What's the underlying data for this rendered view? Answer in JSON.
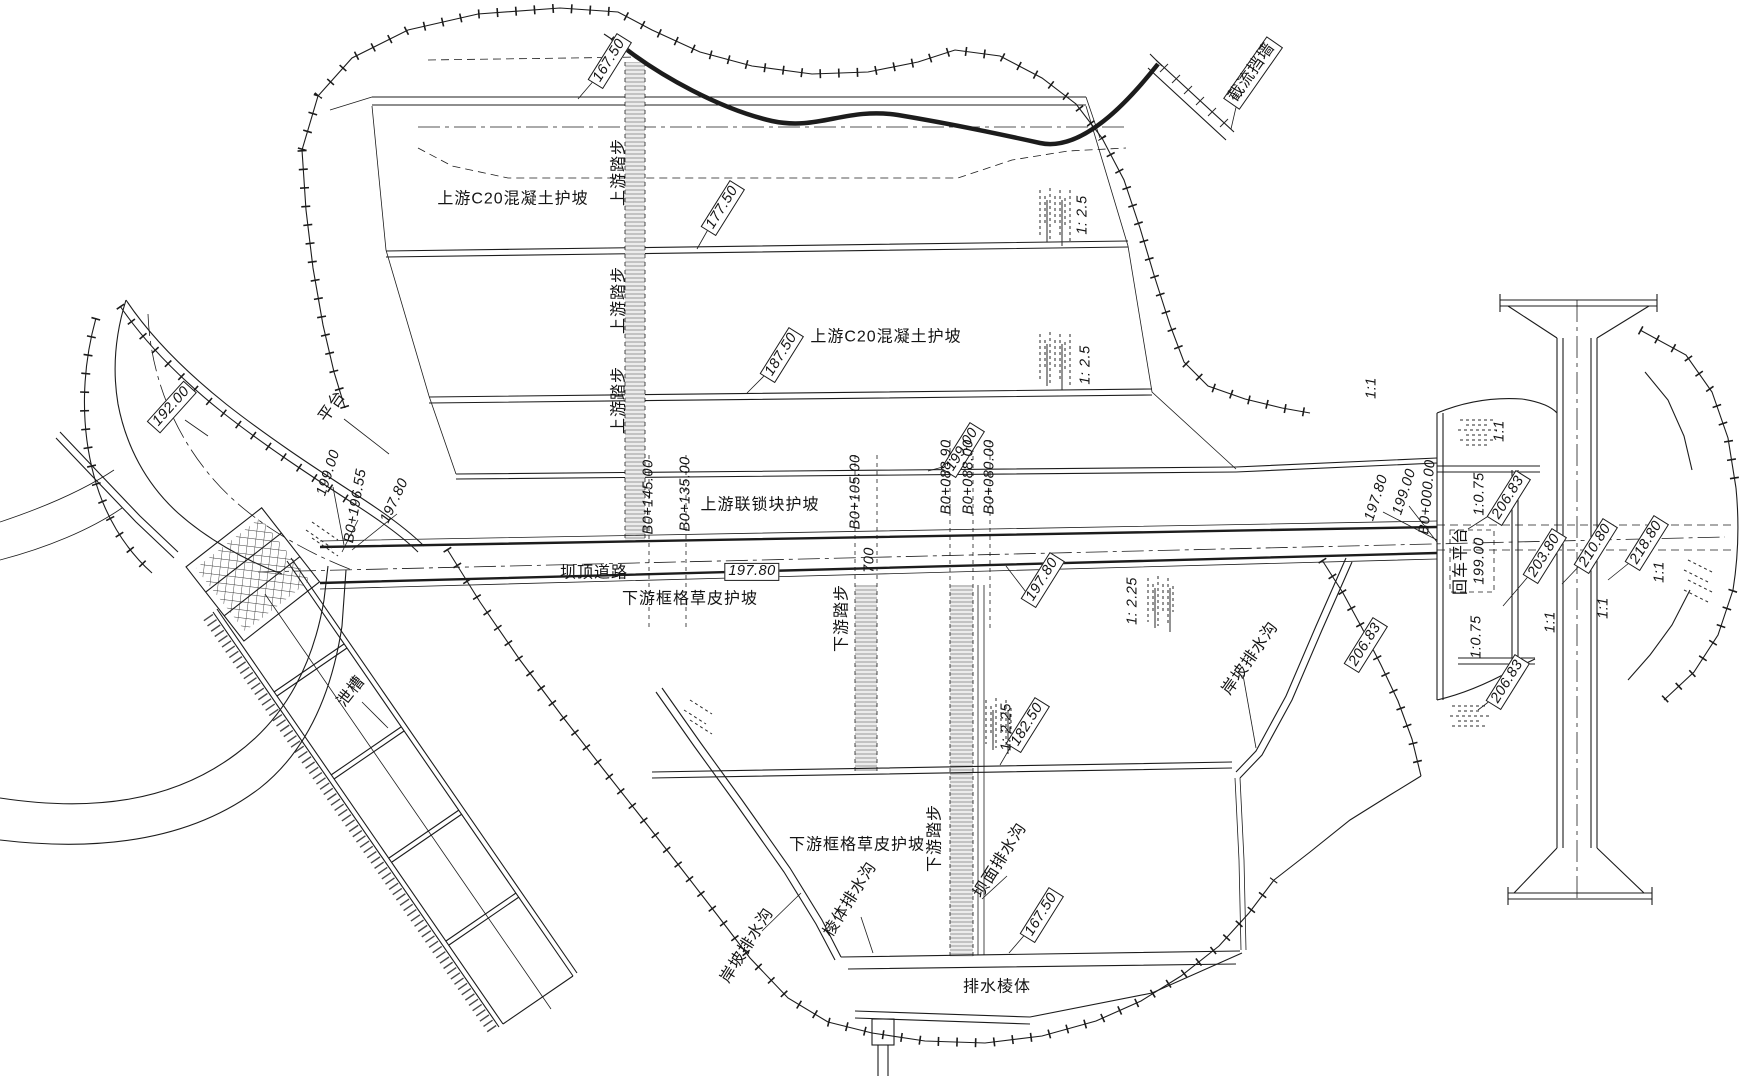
{
  "drawing": {
    "kind": "dam-plan-view",
    "language": "zh-CN",
    "colors": {
      "line": "#1c1c1c",
      "background": "#ffffff",
      "stair_hatch": "#e8e8e8"
    }
  },
  "labels": [
    {
      "name": "elev-167-50-upstream",
      "text": "167.50",
      "x": 610,
      "y": 61,
      "rot": -58,
      "box": true,
      "kind": "num"
    },
    {
      "name": "upstream-steps-1",
      "text": "上游踏步",
      "x": 620,
      "y": 172,
      "rot": -90,
      "box": false,
      "kind": "cn"
    },
    {
      "name": "upstream-c20-slope-1",
      "text": "上游C20混凝土护坡",
      "x": 513,
      "y": 200,
      "rot": 0,
      "box": false,
      "kind": "cn"
    },
    {
      "name": "elev-177-50",
      "text": "177.50",
      "x": 723,
      "y": 208,
      "rot": -58,
      "box": true,
      "kind": "num"
    },
    {
      "name": "slope-1-2-5-a",
      "text": "1: 2.5",
      "x": 1083,
      "y": 215,
      "rot": -90,
      "box": false,
      "kind": "num"
    },
    {
      "name": "upstream-steps-2",
      "text": "上游踏步",
      "x": 620,
      "y": 300,
      "rot": -90,
      "box": false,
      "kind": "cn"
    },
    {
      "name": "upstream-c20-slope-2",
      "text": "上游C20混凝土护坡",
      "x": 886,
      "y": 338,
      "rot": 0,
      "box": false,
      "kind": "cn"
    },
    {
      "name": "elev-187-50",
      "text": "187.50",
      "x": 782,
      "y": 355,
      "rot": -58,
      "box": true,
      "kind": "num"
    },
    {
      "name": "slope-1-2-5-b",
      "text": "1: 2.5",
      "x": 1086,
      "y": 365,
      "rot": -90,
      "box": false,
      "kind": "num"
    },
    {
      "name": "upstream-steps-3",
      "text": "上游踏步",
      "x": 620,
      "y": 400,
      "rot": -90,
      "box": false,
      "kind": "cn"
    },
    {
      "name": "closure-wall-label",
      "text": "截流挡墙",
      "x": 1253,
      "y": 73,
      "rot": -55,
      "box": true,
      "kind": "cn"
    },
    {
      "name": "elev-199-00-upstream",
      "text": "199.00",
      "x": 963,
      "y": 450,
      "rot": -58,
      "box": true,
      "kind": "num"
    },
    {
      "name": "upstream-interlock-slope",
      "text": "上游联锁块护坡",
      "x": 760,
      "y": 506,
      "rot": 0,
      "box": false,
      "kind": "cn"
    },
    {
      "name": "crest-road-label",
      "text": "坝顶道路",
      "x": 594,
      "y": 574,
      "rot": 0,
      "box": false,
      "kind": "cn"
    },
    {
      "name": "elev-197-80-road",
      "text": "197.80",
      "x": 752,
      "y": 572,
      "rot": 0,
      "box": true,
      "kind": "num"
    },
    {
      "name": "station-b0-145",
      "text": "B0+145.00",
      "x": 649,
      "y": 497,
      "rot": -90,
      "box": false,
      "kind": "num"
    },
    {
      "name": "station-b0-135",
      "text": "B0+135.00",
      "x": 686,
      "y": 494,
      "rot": -90,
      "box": false,
      "kind": "num"
    },
    {
      "name": "station-b0-105",
      "text": "B0+105.00",
      "x": 856,
      "y": 492,
      "rot": -90,
      "box": false,
      "kind": "num"
    },
    {
      "name": "dim-700",
      "text": "700",
      "x": 870,
      "y": 560,
      "rot": -90,
      "box": false,
      "kind": "num"
    },
    {
      "name": "station-b0-088-90",
      "text": "B0+088.90",
      "x": 947,
      "y": 477,
      "rot": -90,
      "box": false,
      "kind": "num"
    },
    {
      "name": "station-b0-088-00",
      "text": "B0+088.00",
      "x": 969,
      "y": 477,
      "rot": -90,
      "box": false,
      "kind": "num"
    },
    {
      "name": "station-b0-080-00",
      "text": "B0+080.00",
      "x": 990,
      "y": 477,
      "rot": -90,
      "box": false,
      "kind": "num"
    },
    {
      "name": "elev-192-00",
      "text": "192.00",
      "x": 172,
      "y": 407,
      "rot": -48,
      "box": true,
      "kind": "num"
    },
    {
      "name": "platform-label",
      "text": "平台",
      "x": 333,
      "y": 407,
      "rot": -55,
      "box": false,
      "kind": "cn"
    },
    {
      "name": "elev-199-00-left",
      "text": "199.00",
      "x": 329,
      "y": 473,
      "rot": -72,
      "box": false,
      "kind": "num"
    },
    {
      "name": "station-b0-196-55",
      "text": "B0+196.55",
      "x": 356,
      "y": 506,
      "rot": -80,
      "box": false,
      "kind": "num"
    },
    {
      "name": "elev-197-80-left",
      "text": "197.80",
      "x": 395,
      "y": 501,
      "rot": -65,
      "box": false,
      "kind": "num"
    },
    {
      "name": "chute-label",
      "text": "泄槽",
      "x": 352,
      "y": 692,
      "rot": -52,
      "box": false,
      "kind": "cn"
    },
    {
      "name": "downstream-grass-slope-1",
      "text": "下游框格草皮护坡",
      "x": 690,
      "y": 600,
      "rot": 0,
      "box": false,
      "kind": "cn"
    },
    {
      "name": "elev-197-80-downstream",
      "text": "197.80",
      "x": 1043,
      "y": 580,
      "rot": -58,
      "box": true,
      "kind": "num"
    },
    {
      "name": "slope-1-2-25-a",
      "text": "1: 2.25",
      "x": 1133,
      "y": 601,
      "rot": -90,
      "box": false,
      "kind": "num"
    },
    {
      "name": "downstream-steps-1",
      "text": "下游踏步",
      "x": 843,
      "y": 618,
      "rot": -90,
      "box": false,
      "kind": "cn"
    },
    {
      "name": "elev-182-50",
      "text": "182.50",
      "x": 1028,
      "y": 725,
      "rot": -58,
      "box": true,
      "kind": "num"
    },
    {
      "name": "bank-drain-right",
      "text": "岸坡排水沟",
      "x": 1251,
      "y": 659,
      "rot": -55,
      "box": false,
      "kind": "cn"
    },
    {
      "name": "slope-1-2-25-b",
      "text": "1: 2.25",
      "x": 1007,
      "y": 727,
      "rot": -90,
      "box": false,
      "kind": "num"
    },
    {
      "name": "downstream-grass-slope-2",
      "text": "下游框格草皮护坡",
      "x": 857,
      "y": 846,
      "rot": 0,
      "box": false,
      "kind": "cn"
    },
    {
      "name": "downstream-steps-2",
      "text": "下游踏步",
      "x": 936,
      "y": 838,
      "rot": -90,
      "box": false,
      "kind": "cn"
    },
    {
      "name": "dam-face-drain",
      "text": "坝面排水沟",
      "x": 1001,
      "y": 861,
      "rot": -58,
      "box": false,
      "kind": "cn"
    },
    {
      "name": "elev-167-50-downstream",
      "text": "167.50",
      "x": 1042,
      "y": 915,
      "rot": -58,
      "box": true,
      "kind": "num"
    },
    {
      "name": "prism-drain",
      "text": "棱体排水沟",
      "x": 851,
      "y": 900,
      "rot": -58,
      "box": false,
      "kind": "cn"
    },
    {
      "name": "bank-drain-left",
      "text": "岸坡排水沟",
      "x": 748,
      "y": 946,
      "rot": -58,
      "box": false,
      "kind": "cn"
    },
    {
      "name": "drainage-prism",
      "text": "排水棱体",
      "x": 997,
      "y": 988,
      "rot": 0,
      "box": false,
      "kind": "cn"
    },
    {
      "name": "elev-197-80-right",
      "text": "197.80",
      "x": 1377,
      "y": 498,
      "rot": -72,
      "box": false,
      "kind": "num"
    },
    {
      "name": "elev-199-00-right",
      "text": "199.00",
      "x": 1405,
      "y": 492,
      "rot": -72,
      "box": false,
      "kind": "num"
    },
    {
      "name": "station-b0-000",
      "text": "B0+000.00",
      "x": 1428,
      "y": 497,
      "rot": -85,
      "box": false,
      "kind": "num"
    },
    {
      "name": "slope-1-1-a",
      "text": "1:1",
      "x": 1372,
      "y": 388,
      "rot": -90,
      "box": false,
      "kind": "num"
    },
    {
      "name": "slope-1-1-b",
      "text": "1:1",
      "x": 1500,
      "y": 431,
      "rot": -90,
      "box": false,
      "kind": "num"
    },
    {
      "name": "slope-1-0-75-a",
      "text": "1:0.75",
      "x": 1480,
      "y": 494,
      "rot": -90,
      "box": false,
      "kind": "num"
    },
    {
      "name": "elev-206-83-a",
      "text": "206.83",
      "x": 1509,
      "y": 498,
      "rot": -58,
      "box": true,
      "kind": "num"
    },
    {
      "name": "turnaround-platform",
      "text": "回车平台",
      "x": 1462,
      "y": 561,
      "rot": -90,
      "box": false,
      "kind": "cn"
    },
    {
      "name": "turnaround-elev",
      "text": "199.00",
      "x": 1480,
      "y": 561,
      "rot": -90,
      "box": false,
      "kind": "num"
    },
    {
      "name": "elev-203-80",
      "text": "203.80",
      "x": 1545,
      "y": 556,
      "rot": -58,
      "box": true,
      "kind": "num"
    },
    {
      "name": "elev-210-80",
      "text": "210.80",
      "x": 1596,
      "y": 546,
      "rot": -58,
      "box": true,
      "kind": "num"
    },
    {
      "name": "elev-218-80",
      "text": "218.80",
      "x": 1647,
      "y": 543,
      "rot": -58,
      "box": true,
      "kind": "num"
    },
    {
      "name": "slope-1-1-c",
      "text": "1:1",
      "x": 1660,
      "y": 572,
      "rot": -90,
      "box": false,
      "kind": "num"
    },
    {
      "name": "slope-1-1-d",
      "text": "1:1",
      "x": 1604,
      "y": 608,
      "rot": -90,
      "box": false,
      "kind": "num"
    },
    {
      "name": "slope-1-1-e",
      "text": "1:1",
      "x": 1551,
      "y": 622,
      "rot": -90,
      "box": false,
      "kind": "num"
    },
    {
      "name": "slope-1-0-75-b",
      "text": "1:0.75",
      "x": 1477,
      "y": 637,
      "rot": -90,
      "box": false,
      "kind": "num"
    },
    {
      "name": "elev-206-83-b",
      "text": "206.83",
      "x": 1366,
      "y": 645,
      "rot": -58,
      "box": true,
      "kind": "num"
    },
    {
      "name": "elev-206-83-c",
      "text": "206.83",
      "x": 1508,
      "y": 682,
      "rot": -58,
      "box": true,
      "kind": "num"
    }
  ]
}
